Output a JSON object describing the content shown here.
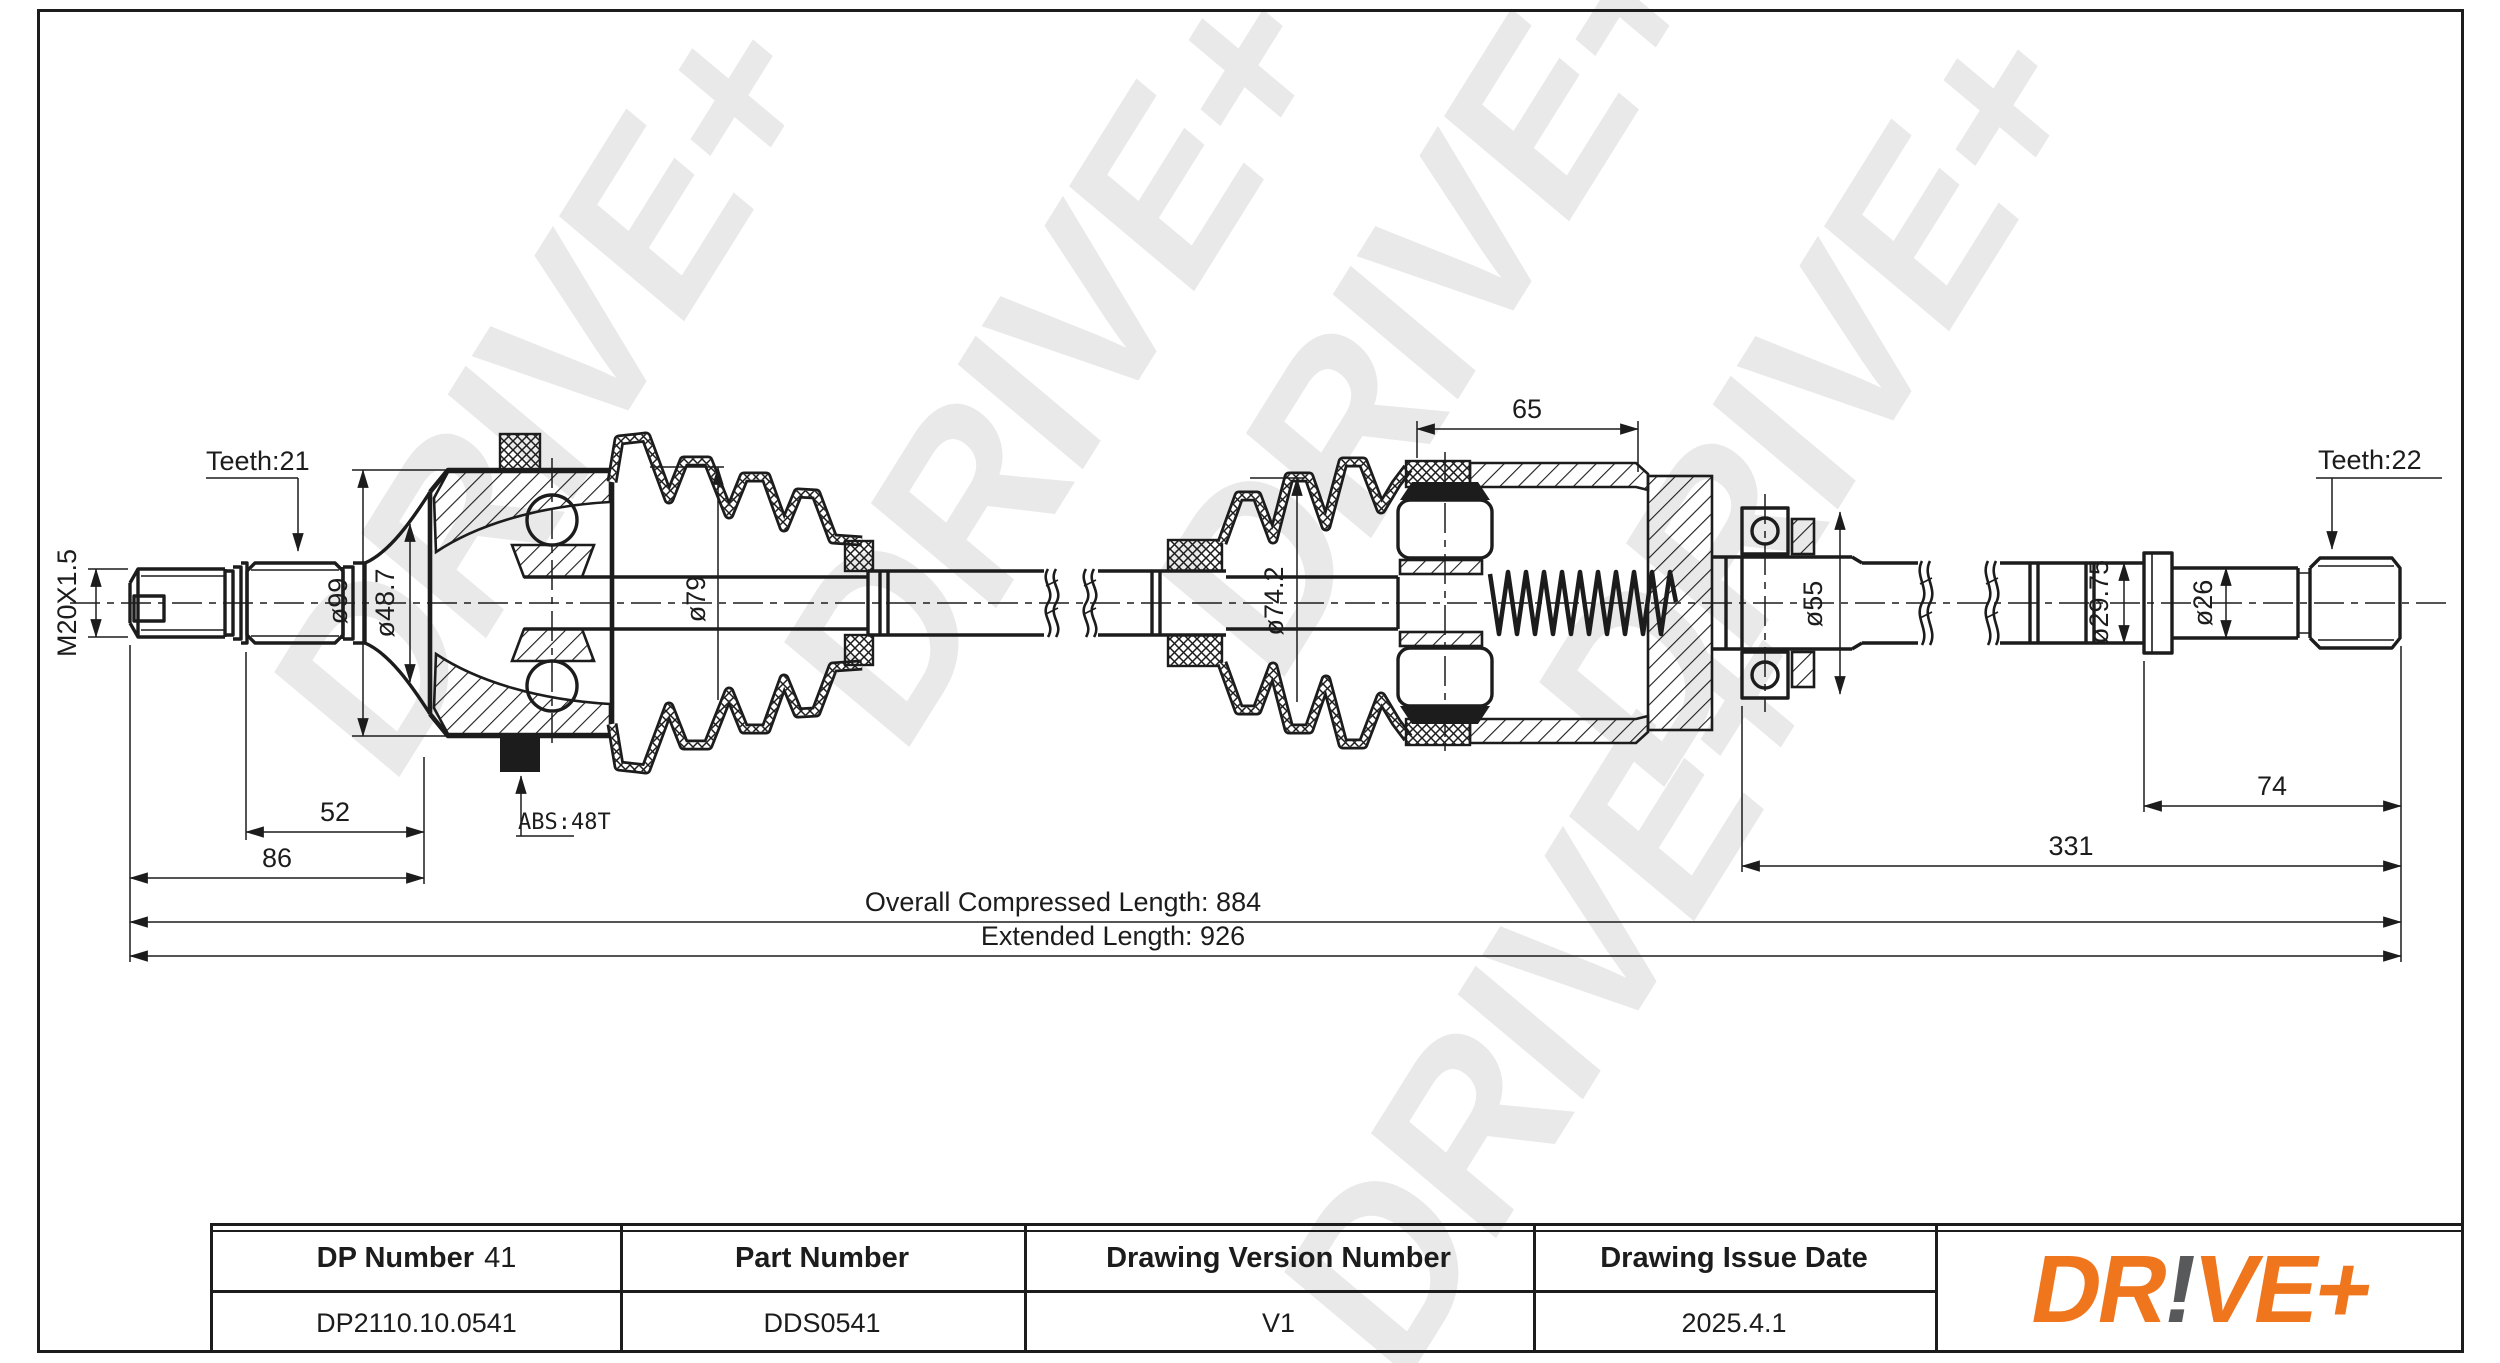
{
  "watermark": {
    "text": "DRIVE+",
    "color": "#e9e9e9"
  },
  "logo": {
    "dr": "DR",
    "bang": "!",
    "ve": "VE+",
    "orange": "#F0761E",
    "gray": "#58595B"
  },
  "drawing": {
    "labels": {
      "teeth_left": "Teeth:21",
      "thread": "M20X1.5",
      "dia_housing": "ø99",
      "dia_inner_race": "ø48.7",
      "dia_boot_left": "ø79",
      "abs_ring": "ABS:48T",
      "dia_boot_right": "ø74.2",
      "dia_bearing": "ø55",
      "dia_shaft_right": "ø29.75",
      "dia_spline_seat": "ø26",
      "teeth_right": "Teeth:22"
    },
    "dimensions": {
      "d52": "52",
      "d86": "86",
      "d65": "65",
      "d74": "74",
      "d331": "331",
      "compressed": "Overall Compressed Length: 884",
      "extended": "Extended Length: 926"
    }
  },
  "title_block": {
    "columns": [
      {
        "header": "DP Number",
        "header_suffix": "41",
        "value": "DP2110.10.0541"
      },
      {
        "header": "Part Number",
        "value": "DDS0541"
      },
      {
        "header": "Drawing Version Number",
        "value": "V1"
      },
      {
        "header": "Drawing Issue Date",
        "value": "2025.4.1"
      }
    ]
  }
}
